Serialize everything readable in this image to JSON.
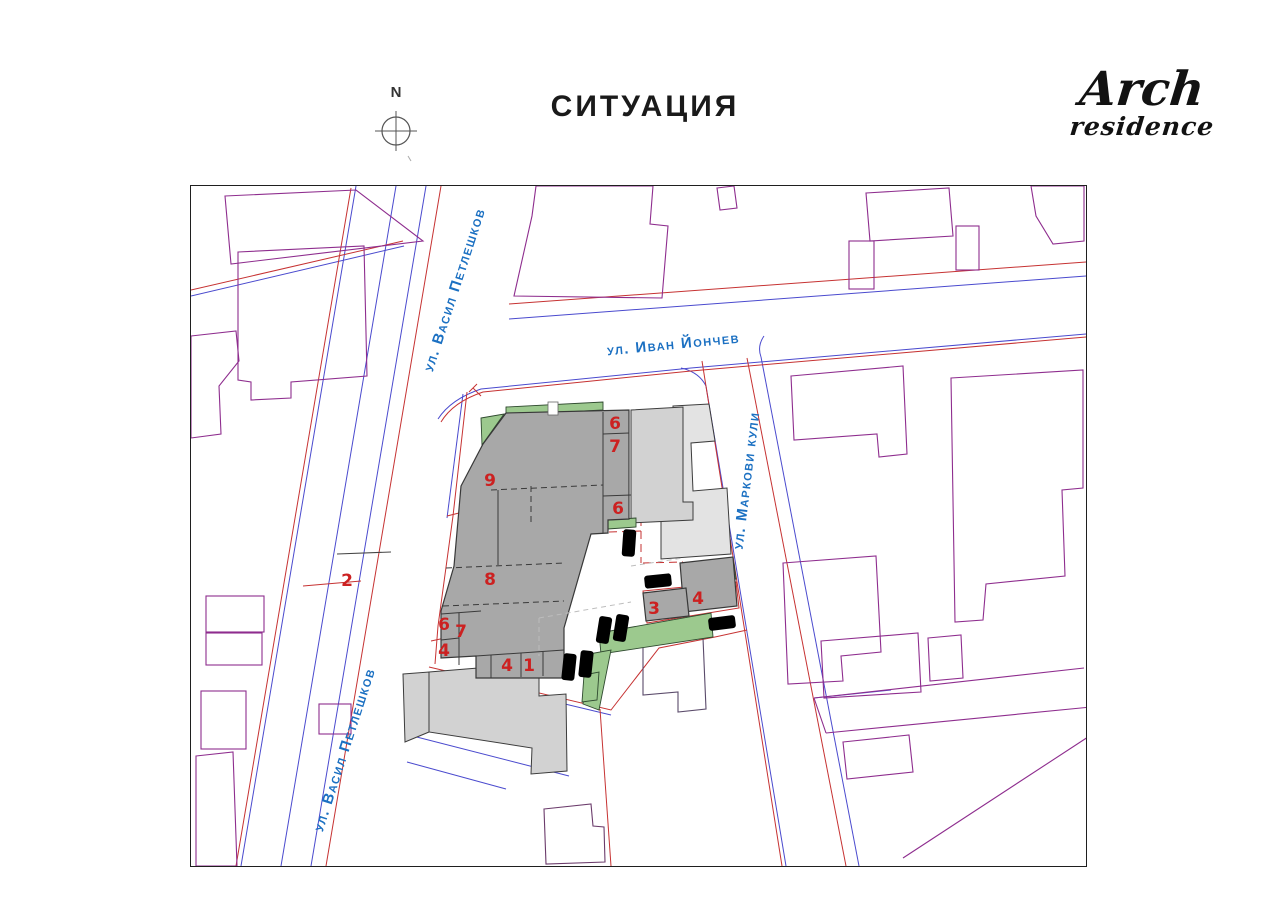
{
  "page": {
    "title": "СИТУАЦИЯ",
    "north_label": "N"
  },
  "logo": {
    "line1": "Arch",
    "line2": "residence"
  },
  "map": {
    "streets": {
      "vasil": "ул. Васил Петлешков",
      "ivan": "ул. Иван Йончев",
      "markovi": "ул. Маркови кули"
    },
    "building_numbers": [
      "6",
      "7",
      "9",
      "6",
      "8",
      "2",
      "6",
      "7",
      "4",
      "4",
      "1",
      "3",
      "4"
    ],
    "colors": {
      "dark_gray": "#a8a8a8",
      "mid_gray": "#d2d2d2",
      "light_gray": "#e3e3e3",
      "green": "#9cc98e",
      "purple": "#8e2d8e",
      "blue_line": "#4a4ace",
      "red_line": "#c63232",
      "label_blue": "#1b70c2",
      "number_red": "#cc2121"
    }
  }
}
